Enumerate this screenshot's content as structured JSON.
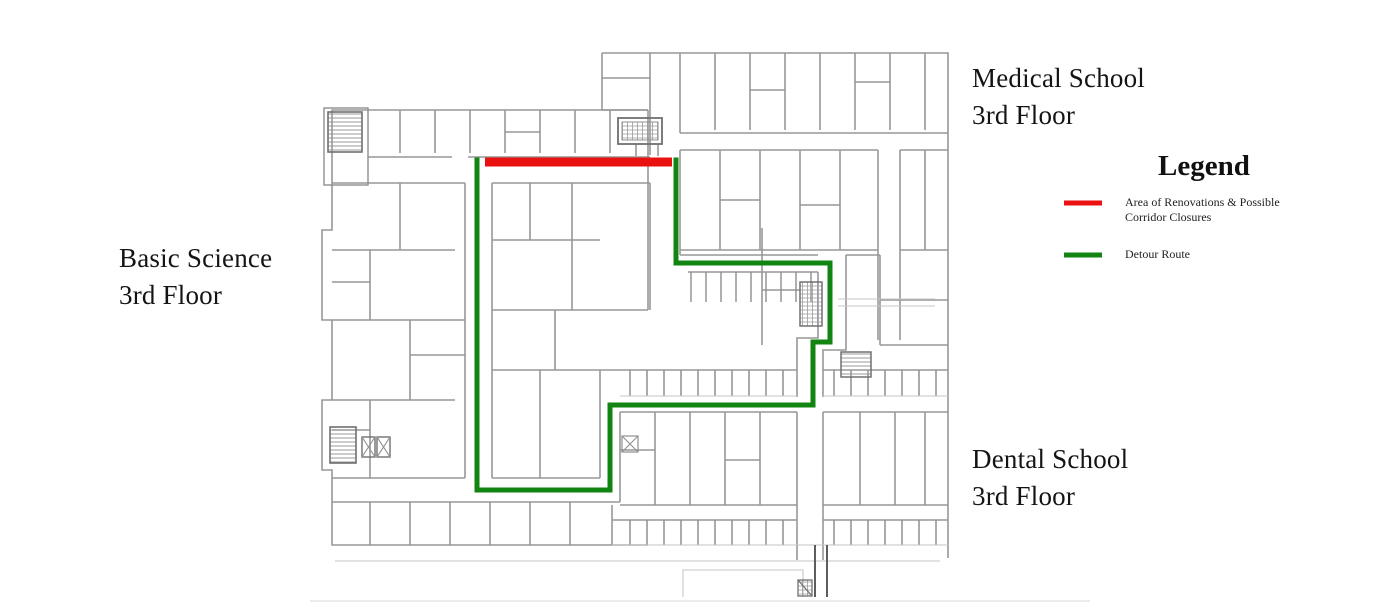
{
  "title_labels": {
    "basic_science": {
      "line1": "Basic Science",
      "line2": "3rd Floor"
    },
    "medical_school": {
      "line1": "Medical School",
      "line2": "3rd Floor"
    },
    "dental_school": {
      "line1": "Dental School",
      "line2": "3rd Floor"
    }
  },
  "legend": {
    "title": "Legend",
    "items": [
      {
        "name": "renovations",
        "color": "#ea1111",
        "label_line1": "Area of Renovations & Possible",
        "label_line2": "Corridor Closures"
      },
      {
        "name": "detour-route",
        "color": "#128412",
        "label_line1": "Detour Route",
        "label_line2": ""
      }
    ]
  },
  "map": {
    "renovation_line": {
      "color": "#ea1111",
      "width": 9,
      "points": [
        [
          485,
          162
        ],
        [
          672,
          162
        ]
      ]
    },
    "detour_route": {
      "color": "#128412",
      "width": 5,
      "points": [
        [
          477,
          160
        ],
        [
          477,
          490
        ],
        [
          610,
          490
        ],
        [
          610,
          405
        ],
        [
          813,
          405
        ],
        [
          813,
          342
        ],
        [
          830,
          342
        ],
        [
          830,
          263
        ],
        [
          676,
          263
        ],
        [
          676,
          160
        ]
      ]
    }
  }
}
